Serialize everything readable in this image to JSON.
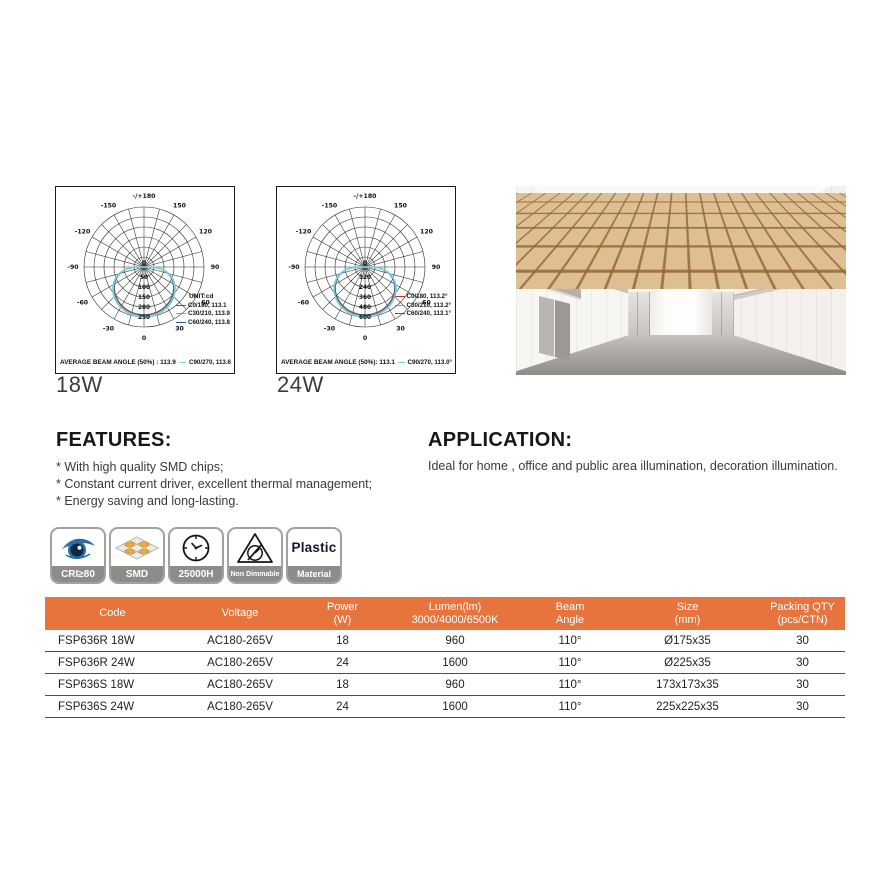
{
  "page": {
    "bg": "#ffffff",
    "accent_orange": "#E6743C"
  },
  "chart_data": [
    {
      "type": "line",
      "variant": "polar photometric candela distribution",
      "title": "18W",
      "unit_label": "UNIT:cd",
      "grid_max": 300,
      "ring_values": [
        50,
        100,
        150,
        200,
        250
      ],
      "center_label": "0",
      "angle_labels": [
        {
          "deg": 180,
          "text": "-/+180"
        },
        {
          "deg": -150,
          "text": "-150"
        },
        {
          "deg": 150,
          "text": "150"
        },
        {
          "deg": -120,
          "text": "-120"
        },
        {
          "deg": 120,
          "text": "120"
        },
        {
          "deg": -90,
          "text": "-90"
        },
        {
          "deg": 90,
          "text": "90"
        },
        {
          "deg": -60,
          "text": "-60"
        },
        {
          "deg": 60,
          "text": "60"
        },
        {
          "deg": -30,
          "text": "-30"
        },
        {
          "deg": 30,
          "text": "30"
        },
        {
          "deg": 0,
          "text": "0"
        }
      ],
      "lobe_exponent": 0.5,
      "series": [
        {
          "name": "C0/180, 113.1",
          "color": "#c0392b",
          "peak": 242
        },
        {
          "name": "C30/210, 113.9",
          "color": "#8aa93d",
          "peak": 248
        },
        {
          "name": "C60/240, 113.8",
          "color": "#2f5a83",
          "peak": 238
        },
        {
          "name": "C90/270, 113.6",
          "color": "#7bd0e4",
          "peak": 250
        }
      ],
      "average_text": "AVERAGE BEAM ANGLE (50%) : 113.9"
    },
    {
      "type": "line",
      "variant": "polar photometric candela distribution",
      "title": "24W",
      "unit_label": "",
      "grid_max": 720,
      "ring_values": [
        120,
        240,
        360,
        480,
        600
      ],
      "center_label": "0",
      "angle_labels": [
        {
          "deg": 180,
          "text": "-/+180"
        },
        {
          "deg": -150,
          "text": "-150"
        },
        {
          "deg": 150,
          "text": "150"
        },
        {
          "deg": -120,
          "text": "-120"
        },
        {
          "deg": 120,
          "text": "120"
        },
        {
          "deg": -90,
          "text": "-90"
        },
        {
          "deg": 90,
          "text": "90"
        },
        {
          "deg": -60,
          "text": "-60"
        },
        {
          "deg": 60,
          "text": "60"
        },
        {
          "deg": -30,
          "text": "-30"
        },
        {
          "deg": 30,
          "text": "30"
        },
        {
          "deg": 0,
          "text": "0"
        }
      ],
      "lobe_exponent": 0.5,
      "series": [
        {
          "name": "C0/180, 113.2°",
          "color": "#c0392b",
          "peak": 582
        },
        {
          "name": "C30/210, 113.2°",
          "color": "#8aa93d",
          "peak": 594
        },
        {
          "name": "C60/240, 113.1°",
          "color": "#2f5a83",
          "peak": 572
        },
        {
          "name": "C90/270, 113.0°",
          "color": "#7bd0e4",
          "peak": 600
        }
      ],
      "average_text": "AVERAGE BEAM ANGLE (50%): 113.1"
    }
  ],
  "features": {
    "title": "FEATURES:",
    "items": [
      "* With high quality SMD chips;",
      "* Constant current driver, excellent thermal management;",
      "* Energy saving and long-lasting."
    ]
  },
  "application": {
    "title": "APPLICATION:",
    "text": "Ideal for home , office and public area illumination, decoration illumination."
  },
  "badges": [
    {
      "icon": "eye-icon",
      "label": "CRI≥80"
    },
    {
      "icon": "smd-chip-icon",
      "label": "SMD"
    },
    {
      "icon": "clock-icon",
      "label": "25000H"
    },
    {
      "icon": "non-dimmable-icon",
      "label": "Non Dimmable"
    },
    {
      "icon": "plastic-material-icon",
      "label": "Material",
      "icon_text": "Plastic"
    }
  ],
  "table": {
    "header_bg": "#E6743C",
    "columns": [
      {
        "line1": "Code",
        "line2": ""
      },
      {
        "line1": "Voltage",
        "line2": ""
      },
      {
        "line1": "Power",
        "line2": "(W)"
      },
      {
        "line1": "Lumen(lm)",
        "line2": "3000/4000/6500K"
      },
      {
        "line1": "Beam",
        "line2": "Angle"
      },
      {
        "line1": "Size",
        "line2": "(mm)"
      },
      {
        "line1": "Packing QTY",
        "line2": "(pcs/CTN)"
      }
    ],
    "rows": [
      [
        "FSP636R 18W",
        "AC180-265V",
        "18",
        "960",
        "110°",
        "Ø175x35",
        "30"
      ],
      [
        "FSP636R 24W",
        "AC180-265V",
        "24",
        "1600",
        "110°",
        "Ø225x35",
        "30"
      ],
      [
        "FSP636S 18W",
        "AC180-265V",
        "18",
        "960",
        "110°",
        "173x173x35",
        "30"
      ],
      [
        "FSP636S 24W",
        "AC180-265V",
        "24",
        "1600",
        "110°",
        "225x225x35",
        "30"
      ]
    ]
  }
}
